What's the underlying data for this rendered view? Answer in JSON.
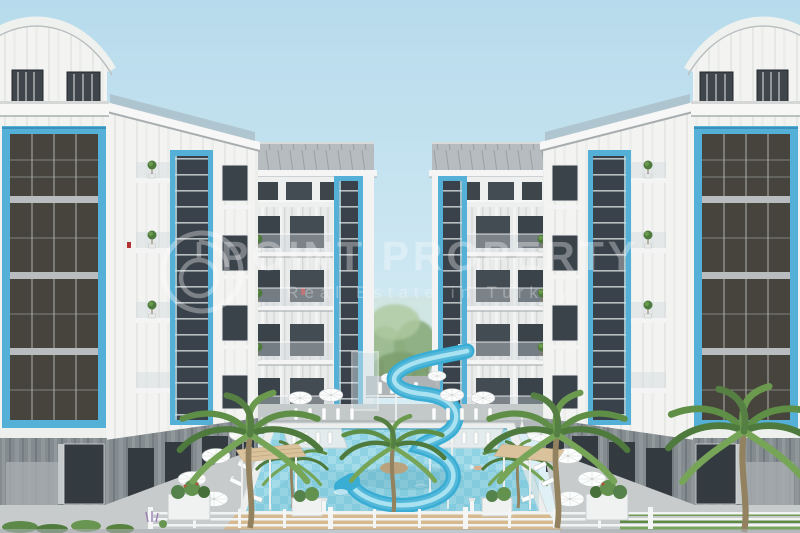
{
  "meta": {
    "type": "architectural-render",
    "subject": "Residential complex with two white apartment towers, blue window frames, courtyard swimming pool, spiral waterslide and palm trees"
  },
  "watermark": {
    "brand": "POINT PROPERTY",
    "tagline": "Real Estate in Turkey",
    "logo": "point-property-ring-logo"
  },
  "palette": {
    "sky_top": "#b7dbec",
    "sky_bottom": "#e3f2f7",
    "accent": "#55b0d8",
    "accent_deep": "#3b93bd",
    "glass": "#3a424a",
    "wall": "#f4f5f3",
    "stone": "#7e868b",
    "roof": "#b6bcbf",
    "water": "#8fd2e3",
    "tile": "#b5e5ef",
    "slide": "#3aadd4",
    "slide_hi": "#a9e3f1",
    "palm": "#5f8f47",
    "deck": "#d6b98e",
    "pave": "#c7cbcc",
    "wm": "#ffffff"
  },
  "scene": {
    "elements": [
      "left-apartment-tower",
      "right-apartment-tower",
      "left-mid-block",
      "right-mid-block",
      "courtyard-trees",
      "swimming-pool",
      "water-slide",
      "palm-trees",
      "sun-umbrellas",
      "sun-loungers",
      "pergolas",
      "planters",
      "perimeter-fence"
    ]
  }
}
